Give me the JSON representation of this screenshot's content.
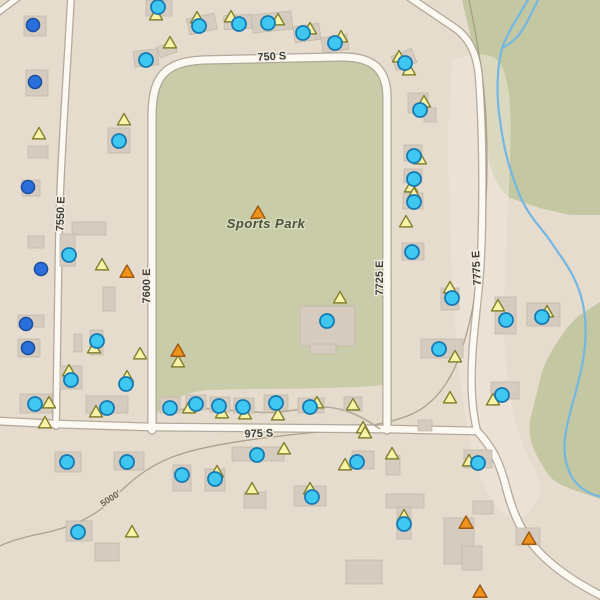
{
  "map": {
    "park_label": "Sports Park",
    "contour_label": "5000'",
    "street_labels": [
      {
        "id": "750-s",
        "text": "750 S",
        "x": 272,
        "y": 60,
        "rot": -3
      },
      {
        "id": "975-s",
        "text": "975 S",
        "x": 259,
        "y": 437,
        "rot": -2
      },
      {
        "id": "7550-e",
        "text": "7550 E",
        "x": 64,
        "y": 214,
        "rot": -88
      },
      {
        "id": "7600-e",
        "text": "7600 E",
        "x": 150,
        "y": 286,
        "rot": -90
      },
      {
        "id": "7725-e",
        "text": "7725 E",
        "x": 383,
        "y": 278,
        "rot": -90
      },
      {
        "id": "7775-e",
        "text": "7775 E",
        "x": 480,
        "y": 268,
        "rot": -93
      }
    ],
    "colors": {
      "background": "#e6dcce",
      "park_fill": "#c8cca8",
      "natural_fill": "#c4c8a2",
      "light_patch": "#eee6d9",
      "road_fill": "#fcf9f2",
      "road_casing": "#a89e90",
      "driveway": "#b5ab9d",
      "stream": "#74b7e2",
      "contour": "#a2967f",
      "building_fill": "#d5ccbf",
      "building_stroke": "#c3b9aa",
      "blue_marker": "#2b6fdd",
      "blue_marker_rim": "#1c4f9e",
      "cyan_marker": "#3ec7f0",
      "cyan_marker_rim": "#1779b4",
      "yellow_tri": "#f8f3a6",
      "yellow_tri_rim": "#83812f",
      "orange_tri": "#f0931d",
      "orange_tri_rim": "#9c5a12",
      "street_label_color": "#413f3a",
      "park_label_color": "#4a5340",
      "contour_label_color": "#6d6354"
    },
    "park_path": "M 152,422 L 152,116 C 152,80 162,64 200,62 L 338,59 C 370,58 385,70 385,98 L 385,385 C 330,390 260,388 210,390 C 180,392 160,405 152,422 Z",
    "natural_paths": [
      "M 462,0 L 600,0 L 600,215 L 570,215 L 540,208 L 510,198 C 500,190 492,178 488,155 C 484,125 478,70 468,25 Z",
      "M 600,302 L 580,315 C 570,323 558,338 546,362 C 540,375 538,390 530,420 C 528,440 533,452 550,477 C 562,488 578,491 600,499 Z"
    ],
    "light_patch_path": "M 452,60 C 470,52 490,52 500,62 C 510,82 512,110 510,160 C 508,230 502,290 505,350 C 508,400 518,440 535,470 C 545,488 540,505 525,515 C 505,528 488,500 478,470 C 468,438 462,400 458,360 C 452,300 448,200 448,130 Z",
    "contour_paths": [
      "M 469,0 C 477,38 484,78 486,118 C 488,162 487,200 483,232 C 479,282 471,322 461,352 C 450,384 434,404 412,414 C 388,425 348,429 308,433 C 258,438 214,444 184,453 C 154,462 134,477 114,498 C 94,518 68,528 44,533 C 24,537 10,541 0,546"
    ],
    "stream_paths": [
      "M 528,0 C 517,18 506,36 502,48 C 497,68 496,95 500,120 C 504,152 511,175 521,198 C 530,218 543,230 549,239 C 561,257 572,270 579,290 C 586,310 587,332 584,354 C 580,382 572,402 567,426 C 562,448 565,466 573,479 C 581,490 592,495 602,497",
      "M 538,0 C 531,14 524,30 516,38 C 510,44 506,46 502,48"
    ],
    "roads": [
      {
        "name": "750-s-park-loop",
        "d": "M 152,430 L 152,118 C 152,78 163,62 203,60 L 338,57 C 372,56 387,68 387,98 L 387,430",
        "w": 7
      },
      {
        "name": "7550-e",
        "d": "M 71,-3 C 66,90 60,170 59,230 C 58,300 57,370 56,426",
        "w": 5.5
      },
      {
        "name": "975-s",
        "d": "M -3,421 L 56,424 L 151,427 L 387,429 L 477,431",
        "w": 6.5
      },
      {
        "name": "975-s-southeast-curve",
        "d": "M 477,431 C 493,448 499,462 505,483 C 512,512 522,536 544,557 C 562,574 582,586 602,596",
        "w": 6.5
      },
      {
        "name": "7775-e",
        "d": "M 409,-3 L 452,26 C 468,36 477,52 479,78 C 482,120 483,170 482,225 C 481,280 477,300 473,345 C 470,385 472,410 477,431",
        "w": 6
      },
      {
        "name": "corner-stub",
        "d": "M -4,14 L 20,-4",
        "w": 5
      }
    ],
    "driveways": [
      "M 163,413 C 210,400 250,420 300,409 C 335,401 362,416 380,429"
    ],
    "buildings": [
      [
        24,
        16,
        22,
        20,
        0
      ],
      [
        26,
        70,
        22,
        26,
        0
      ],
      [
        146,
        0,
        26,
        16,
        0
      ],
      [
        188,
        16,
        28,
        16,
        -12
      ],
      [
        224,
        15,
        28,
        14,
        -3
      ],
      [
        158,
        44,
        18,
        11,
        -20
      ],
      [
        134,
        50,
        24,
        16,
        -6
      ],
      [
        252,
        13,
        40,
        18,
        -6
      ],
      [
        294,
        25,
        26,
        16,
        -8
      ],
      [
        322,
        36,
        26,
        15,
        -8
      ],
      [
        393,
        52,
        22,
        15,
        -22
      ],
      [
        408,
        93,
        20,
        20,
        0
      ],
      [
        424,
        108,
        12,
        14,
        0
      ],
      [
        404,
        145,
        18,
        16,
        0
      ],
      [
        404,
        169,
        18,
        14,
        0
      ],
      [
        403,
        193,
        20,
        16,
        0
      ],
      [
        402,
        243,
        22,
        17,
        0
      ],
      [
        441,
        288,
        18,
        22,
        0
      ],
      [
        421,
        339,
        42,
        19,
        0
      ],
      [
        491,
        382,
        28,
        17,
        0
      ],
      [
        495,
        297,
        21,
        37,
        0
      ],
      [
        527,
        303,
        33,
        23,
        0
      ],
      [
        108,
        128,
        22,
        25,
        0
      ],
      [
        28,
        146,
        20,
        12,
        0
      ],
      [
        22,
        180,
        18,
        16,
        0
      ],
      [
        28,
        236,
        16,
        12,
        0
      ],
      [
        72,
        222,
        34,
        13,
        0
      ],
      [
        60,
        234,
        15,
        32,
        0
      ],
      [
        103,
        287,
        12,
        24,
        0
      ],
      [
        90,
        330,
        13,
        25,
        0
      ],
      [
        74,
        334,
        8,
        18,
        0
      ],
      [
        18,
        315,
        26,
        12,
        0
      ],
      [
        18,
        339,
        22,
        18,
        0
      ],
      [
        60,
        366,
        22,
        23,
        0
      ],
      [
        86,
        396,
        42,
        17,
        0
      ],
      [
        20,
        394,
        32,
        19,
        0
      ],
      [
        160,
        397,
        20,
        16,
        0
      ],
      [
        186,
        395,
        20,
        15,
        0
      ],
      [
        210,
        397,
        20,
        15,
        0
      ],
      [
        234,
        398,
        20,
        15,
        0
      ],
      [
        264,
        395,
        24,
        15,
        0
      ],
      [
        298,
        398,
        26,
        15,
        0
      ],
      [
        344,
        397,
        18,
        14,
        0
      ],
      [
        418,
        420,
        14,
        11,
        0
      ],
      [
        300,
        306,
        55,
        40,
        0
      ],
      [
        310,
        344,
        26,
        10,
        0
      ],
      [
        55,
        452,
        26,
        20,
        0
      ],
      [
        114,
        452,
        30,
        18,
        0
      ],
      [
        173,
        465,
        18,
        26,
        0
      ],
      [
        205,
        469,
        20,
        22,
        0
      ],
      [
        232,
        447,
        52,
        14,
        0
      ],
      [
        294,
        486,
        32,
        20,
        0
      ],
      [
        244,
        492,
        22,
        16,
        0
      ],
      [
        66,
        521,
        26,
        20,
        0
      ],
      [
        386,
        494,
        38,
        14,
        0
      ],
      [
        397,
        507,
        14,
        32,
        0
      ],
      [
        352,
        451,
        22,
        18,
        0
      ],
      [
        386,
        455,
        14,
        20,
        0
      ],
      [
        464,
        450,
        28,
        18,
        0
      ],
      [
        444,
        518,
        30,
        46,
        0
      ],
      [
        462,
        546,
        20,
        24,
        0
      ],
      [
        473,
        501,
        20,
        13,
        0
      ],
      [
        516,
        528,
        24,
        17,
        0
      ],
      [
        346,
        560,
        36,
        24,
        0
      ],
      [
        95,
        543,
        24,
        18,
        0
      ]
    ],
    "markers": {
      "blue_circles": [
        [
          33,
          25
        ],
        [
          35,
          82
        ],
        [
          28,
          187
        ],
        [
          41,
          269
        ],
        [
          26,
          324
        ],
        [
          28,
          348
        ]
      ],
      "cyan_circles": [
        [
          158,
          7
        ],
        [
          199,
          26
        ],
        [
          239,
          24
        ],
        [
          268,
          23
        ],
        [
          303,
          33
        ],
        [
          335,
          43
        ],
        [
          146,
          60
        ],
        [
          405,
          63
        ],
        [
          119,
          141
        ],
        [
          420,
          110
        ],
        [
          414,
          156
        ],
        [
          414,
          179
        ],
        [
          414,
          202
        ],
        [
          412,
          252
        ],
        [
          452,
          298
        ],
        [
          439,
          349
        ],
        [
          69,
          255
        ],
        [
          97,
          341
        ],
        [
          71,
          380
        ],
        [
          126,
          384
        ],
        [
          35,
          404
        ],
        [
          107,
          408
        ],
        [
          170,
          408
        ],
        [
          196,
          404
        ],
        [
          219,
          406
        ],
        [
          243,
          407
        ],
        [
          276,
          403
        ],
        [
          310,
          407
        ],
        [
          327,
          321
        ],
        [
          506,
          320
        ],
        [
          542,
          317
        ],
        [
          502,
          395
        ],
        [
          67,
          462
        ],
        [
          127,
          462
        ],
        [
          182,
          475
        ],
        [
          215,
          479
        ],
        [
          257,
          455
        ],
        [
          357,
          462
        ],
        [
          478,
          463
        ],
        [
          312,
          497
        ],
        [
          404,
          524
        ],
        [
          78,
          532
        ]
      ],
      "yellow_triangles": [
        [
          156,
          15
        ],
        [
          197,
          18
        ],
        [
          231,
          17
        ],
        [
          278,
          20
        ],
        [
          310,
          29
        ],
        [
          341,
          37
        ],
        [
          170,
          43
        ],
        [
          399,
          57
        ],
        [
          409,
          70
        ],
        [
          124,
          120
        ],
        [
          39,
          134
        ],
        [
          424,
          102
        ],
        [
          420,
          159
        ],
        [
          411,
          187
        ],
        [
          414,
          194
        ],
        [
          406,
          222
        ],
        [
          450,
          288
        ],
        [
          498,
          306
        ],
        [
          547,
          312
        ],
        [
          455,
          357
        ],
        [
          450,
          398
        ],
        [
          493,
          400
        ],
        [
          102,
          265
        ],
        [
          94,
          348
        ],
        [
          140,
          354
        ],
        [
          69,
          371
        ],
        [
          127,
          377
        ],
        [
          49,
          403
        ],
        [
          45,
          423
        ],
        [
          96,
          412
        ],
        [
          189,
          408
        ],
        [
          222,
          413
        ],
        [
          245,
          414
        ],
        [
          278,
          415
        ],
        [
          317,
          403
        ],
        [
          353,
          405
        ],
        [
          363,
          428
        ],
        [
          178,
          362
        ],
        [
          340,
          298
        ],
        [
          365,
          433
        ],
        [
          345,
          465
        ],
        [
          392,
          454
        ],
        [
          469,
          461
        ],
        [
          284,
          449
        ],
        [
          217,
          472
        ],
        [
          252,
          489
        ],
        [
          310,
          489
        ],
        [
          404,
          516
        ],
        [
          132,
          532
        ]
      ],
      "orange_triangles": [
        [
          258,
          213
        ],
        [
          127,
          272
        ],
        [
          178,
          351
        ],
        [
          466,
          523
        ],
        [
          529,
          539
        ],
        [
          480,
          592
        ]
      ]
    }
  }
}
